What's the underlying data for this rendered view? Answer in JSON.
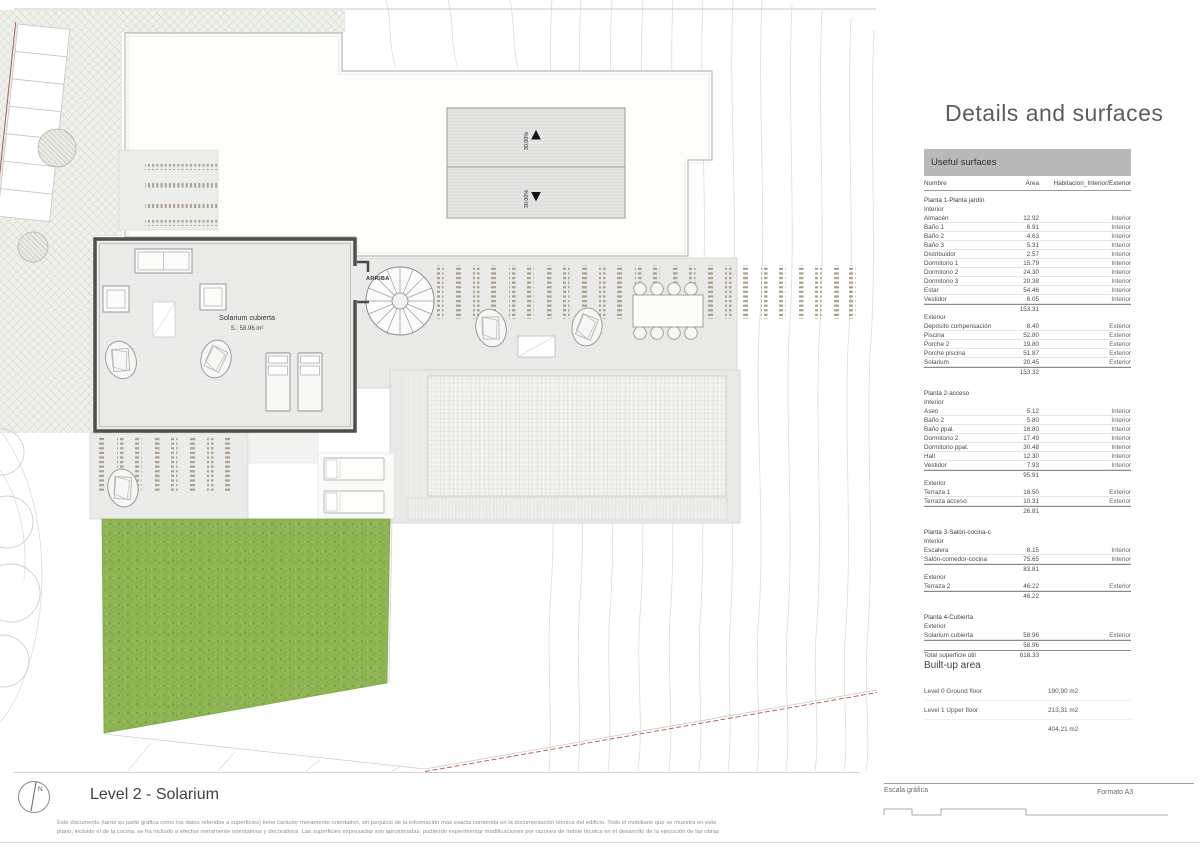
{
  "plan": {
    "title": "Level 2 - Solarium",
    "north_label": "N",
    "room_label": "Solarium cubierta",
    "room_area": "S.: 58.96 m²",
    "stair_label": "ARRIBA",
    "ramp_slope_up": "30.00%",
    "ramp_slope_down": "30.00%"
  },
  "panel": {
    "title": "Details and surfaces",
    "table_header": "Useful surfaces",
    "columns": {
      "name": "Nombre",
      "area": "Área",
      "hab": "Habitacion_Interior/Exterior"
    },
    "rows": [
      {
        "t": "floor",
        "name": "Planta 1-Planta jardín"
      },
      {
        "t": "group",
        "name": "Interior"
      },
      {
        "t": "row",
        "name": "Almacén",
        "area": "12.92",
        "hab": "Interior"
      },
      {
        "t": "row",
        "name": "Baño 1",
        "area": "6.91",
        "hab": "Interior"
      },
      {
        "t": "row",
        "name": "Baño 2",
        "area": "4.63",
        "hab": "Interior"
      },
      {
        "t": "row",
        "name": "Baño 3",
        "area": "5.31",
        "hab": "Interior"
      },
      {
        "t": "row",
        "name": "Distribuidor",
        "area": "2.57",
        "hab": "Interior"
      },
      {
        "t": "row",
        "name": "Dormitorio 1",
        "area": "15.79",
        "hab": "Interior"
      },
      {
        "t": "row",
        "name": "Dormitorio 2",
        "area": "24.30",
        "hab": "Interior"
      },
      {
        "t": "row",
        "name": "Dormitorio 3",
        "area": "20.38",
        "hab": "Interior"
      },
      {
        "t": "row",
        "name": "Estar",
        "area": "54.46",
        "hab": "Interior"
      },
      {
        "t": "row",
        "name": "Vestidor",
        "area": "6.05",
        "hab": "Interior"
      },
      {
        "t": "subtotal",
        "area": "153.31"
      },
      {
        "t": "group",
        "name": "Exterior"
      },
      {
        "t": "row",
        "name": "Deposito compensación",
        "area": "8.40",
        "hab": "Exterior"
      },
      {
        "t": "row",
        "name": "Piscina",
        "area": "52.80",
        "hab": "Exterior"
      },
      {
        "t": "row",
        "name": "Porche 2",
        "area": "19.80",
        "hab": "Exterior"
      },
      {
        "t": "row",
        "name": "Porche piscina",
        "area": "51.87",
        "hab": "Exterior"
      },
      {
        "t": "row",
        "name": "Solarium",
        "area": "20.45",
        "hab": "Exterior"
      },
      {
        "t": "subtotal",
        "area": "153.32"
      },
      {
        "t": "gap"
      },
      {
        "t": "floor",
        "name": "Planta 2-acceso"
      },
      {
        "t": "group",
        "name": "Interior"
      },
      {
        "t": "row",
        "name": "Aseo",
        "area": "5.12",
        "hab": "Interior"
      },
      {
        "t": "row",
        "name": "Baño 2",
        "area": "5.80",
        "hab": "Interior"
      },
      {
        "t": "row",
        "name": "Baño ppal.",
        "area": "16.80",
        "hab": "Interior"
      },
      {
        "t": "row",
        "name": "Dormitorio 2",
        "area": "17.49",
        "hab": "Interior"
      },
      {
        "t": "row",
        "name": "Dormitorio ppal.",
        "area": "30.48",
        "hab": "Interior"
      },
      {
        "t": "row",
        "name": "Hall",
        "area": "12.30",
        "hab": "Interior"
      },
      {
        "t": "row",
        "name": "Vestidor",
        "area": "7.93",
        "hab": "Interior"
      },
      {
        "t": "subtotal",
        "area": "95.91"
      },
      {
        "t": "group",
        "name": "Exterior"
      },
      {
        "t": "row",
        "name": "Terraza 1",
        "area": "16.50",
        "hab": "Exterior"
      },
      {
        "t": "row",
        "name": "Terraza acceso",
        "area": "10.31",
        "hab": "Exterior"
      },
      {
        "t": "subtotal",
        "area": "26.81"
      },
      {
        "t": "gap"
      },
      {
        "t": "floor",
        "name": "Planta 3-Salón-cocina-comedor"
      },
      {
        "t": "group",
        "name": "Interior"
      },
      {
        "t": "row",
        "name": "Escalera",
        "area": "8.15",
        "hab": "Interior"
      },
      {
        "t": "row",
        "name": "Salón-comedor-cocina",
        "area": "75.65",
        "hab": "Interior"
      },
      {
        "t": "subtotal",
        "area": "83.81"
      },
      {
        "t": "group",
        "name": "Exterior"
      },
      {
        "t": "row",
        "name": "Terraza 2",
        "area": "46.22",
        "hab": "Exterior"
      },
      {
        "t": "subtotal",
        "area": "46.22"
      },
      {
        "t": "gap"
      },
      {
        "t": "floor",
        "name": "Planta 4-Cubierta"
      },
      {
        "t": "group",
        "name": "Exterior"
      },
      {
        "t": "row",
        "name": "Solarium cubierta",
        "area": "58.96",
        "hab": "Exterior"
      },
      {
        "t": "subtotal",
        "area": "58.96"
      },
      {
        "t": "total",
        "name": "Total superficie útil",
        "area": "618.33"
      }
    ],
    "built_up": {
      "title": "Built-up area",
      "rows": [
        {
          "label": "Level 0 Ground floor",
          "value": "190,90 m2"
        },
        {
          "label": "Level 1 Upper floor",
          "value": "213,31 m2"
        },
        {
          "label": "",
          "value": "404,21 m2"
        }
      ]
    }
  },
  "footer": {
    "scale_label": "Escala gráfica",
    "format_label": "Formato A3",
    "scale_ticks": [
      {
        "label": "0"
      },
      {
        "label": "1"
      },
      {
        "label": "2"
      },
      {
        "label": "5"
      },
      {
        "label": "10 m"
      }
    ],
    "disclaimer_line1": "Este documento (tanto su parte gráfica como los datos referidos a superficies) tiene carácter meramente orientativo, sin perjuicio de la información más exacta contenida en la documentación técnica del edificio. Todo el mobiliario que se muestra en este",
    "disclaimer_line2": "plano, incluido el de la cocina, se ha incluido a efectos meramente orientativos y decorativos. Las superficies expresadas son aproximadas, pudiendo experimentar modificaciones por razones de índole técnica en el desarrollo de la ejecución de las obras"
  },
  "colors": {
    "lawn": "#8db554",
    "boundary_red": "#b5544a",
    "hatch_line": "#c6cabf",
    "wall": "#4f4f4d"
  }
}
